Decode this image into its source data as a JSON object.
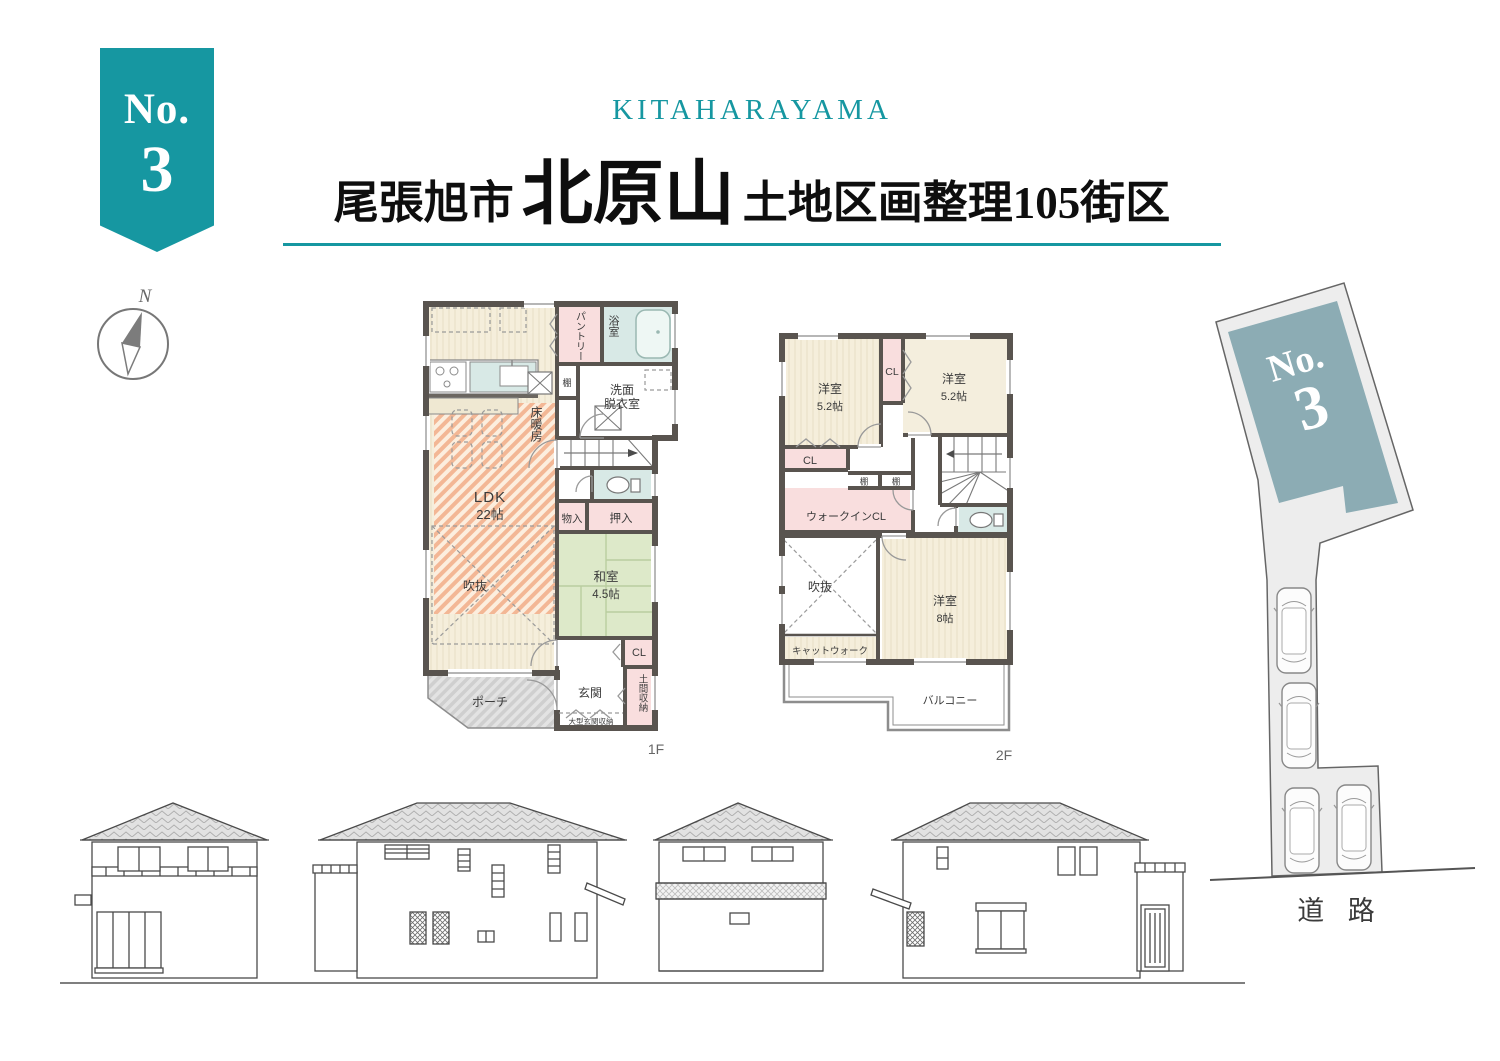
{
  "colors": {
    "teal": "#1697a1",
    "slate": "#8cacb4",
    "wall": "#59544f",
    "pink": "#f9dede",
    "blue": "#d8e9e6",
    "green": "#dde9c9",
    "cream": "#f5eedb",
    "orange": "#f0a47c",
    "lot_gray": "#ededed"
  },
  "ribbon": {
    "label": "No.",
    "number": "3"
  },
  "header": {
    "subtitle": "KITAHARAYAMA",
    "city": "尾張旭市",
    "name": "北原山",
    "suffix": "土地区画整理105街区"
  },
  "compass": {
    "north": "N"
  },
  "plan1f": {
    "floor": "1F",
    "labels": {
      "pantry": "パントリー",
      "bath": "浴室",
      "shelf": "棚",
      "wash1": "洗面",
      "wash2": "脱衣室",
      "heating": "床暖房",
      "ldk": "LDK",
      "ldk_size": "22帖",
      "void": "吹抜",
      "mono": "物入",
      "oshiire": "押入",
      "washitsu": "和室",
      "washitsu_size": "4.5帖",
      "cl": "CL",
      "porch": "ポーチ",
      "genkan": "玄関",
      "doma": "土間収納",
      "large_storage": "大型玄関収納"
    }
  },
  "plan2f": {
    "floor": "2F",
    "labels": {
      "room_a": "洋室",
      "room_a_size": "5.2帖",
      "cl_top": "CL",
      "room_b": "洋室",
      "room_b_size": "5.2帖",
      "cl_left": "CL",
      "shelf1": "棚",
      "shelf2": "棚",
      "wic": "ウォークインCL",
      "void": "吹抜",
      "room_c": "洋室",
      "room_c_size": "8帖",
      "catwalk": "キャットウォーク",
      "balcony": "バルコニー"
    }
  },
  "site": {
    "label": "No.",
    "number": "3",
    "road": "道 路"
  }
}
